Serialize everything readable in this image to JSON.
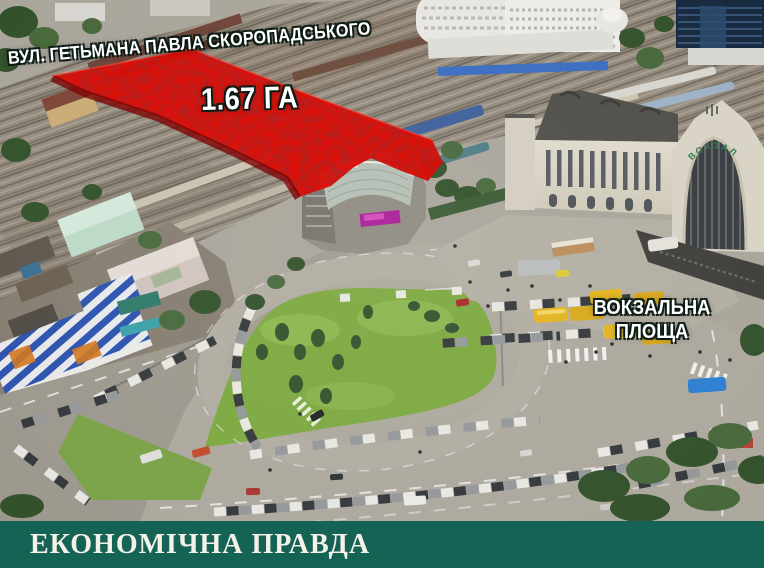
{
  "overlay": {
    "street_label": "ВУЛ. ГЕТЬМАНА ПАВЛА СКОРОПАДСЬКОГО",
    "area_label": "1.67 ГА",
    "square_label_line1": "ВОКЗАЛЬНА",
    "square_label_line2": "ПЛОЩА",
    "highlight_color": "#dd0d06"
  },
  "scene": {
    "station_sign": "ВОКЗАЛ"
  },
  "banner": {
    "text": "ЕКОНОМІЧНА ПРАВДА",
    "background_color": "#156355",
    "text_color": "#f4f1e8"
  }
}
